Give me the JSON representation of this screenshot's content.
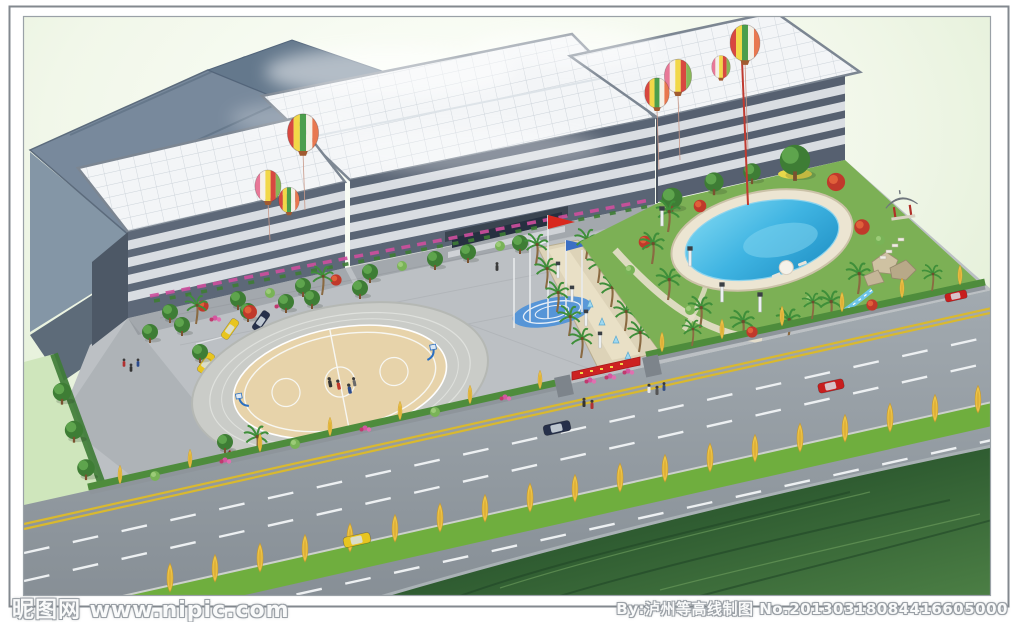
{
  "image": {
    "type": "architectural-aerial-rendering",
    "description": "Bird's-eye architectural rendering of a factory / office campus: saw-tooth blue-grey factory roofs, white grid roofs over ribbon-window office blocks, flag plaza with red and blue flags, palm-lined walkway, landscaped garden with kidney-shaped swimming pool, pavilion and rockery, oval basketball court, parking lot, gatehouse with barrier, striped hot-air balloons, and a wide tree-lined road with green median in front",
    "width": 1024,
    "height": 622
  },
  "watermarks": {
    "bottom_left": "昵图网 www.nipic.com",
    "bottom_right": "By:泸州等高线制图 No.20130318084416605000"
  },
  "palette": {
    "sky_green": "#dcecd0",
    "slate_roof": "#78899c",
    "white_roof": "#f3f5f7",
    "facade": "#5a6575",
    "window_band": "#d9dde2",
    "plaza": "#bcc0c4",
    "road": "#99a1a7",
    "lane_yellow": "#d9b92f",
    "median_green": "#6fae3e",
    "poplar_yellow": "#eec548",
    "tree_green": "#3e7d35",
    "maple_red": "#c0392b",
    "flower_pink": "#d457a0",
    "pool_water": "#3fb4e2",
    "court_tan": "#e6d2a8",
    "grass_dark": "#2a5530",
    "field_light": "#cfe6bc",
    "flag_red": "#d8281e",
    "flag_blue": "#3b6fc4",
    "car_yellow": "#e8c520",
    "car_red": "#c81e1e",
    "car_dark": "#26304a"
  },
  "scene_objects": [
    "saw-tooth factory roofs",
    "white grid roofs",
    "office facades with ribbon windows",
    "entrance canopy",
    "flag plaza",
    "palm-lined walkway",
    "swimming pool with deck",
    "garden pavilion",
    "rockery and stream",
    "basketball court with two hoops",
    "parking lot with cars",
    "gatehouse with barrier",
    "road with green median and poplars",
    "hot-air balloons",
    "pedestrians",
    "dark grass field"
  ]
}
